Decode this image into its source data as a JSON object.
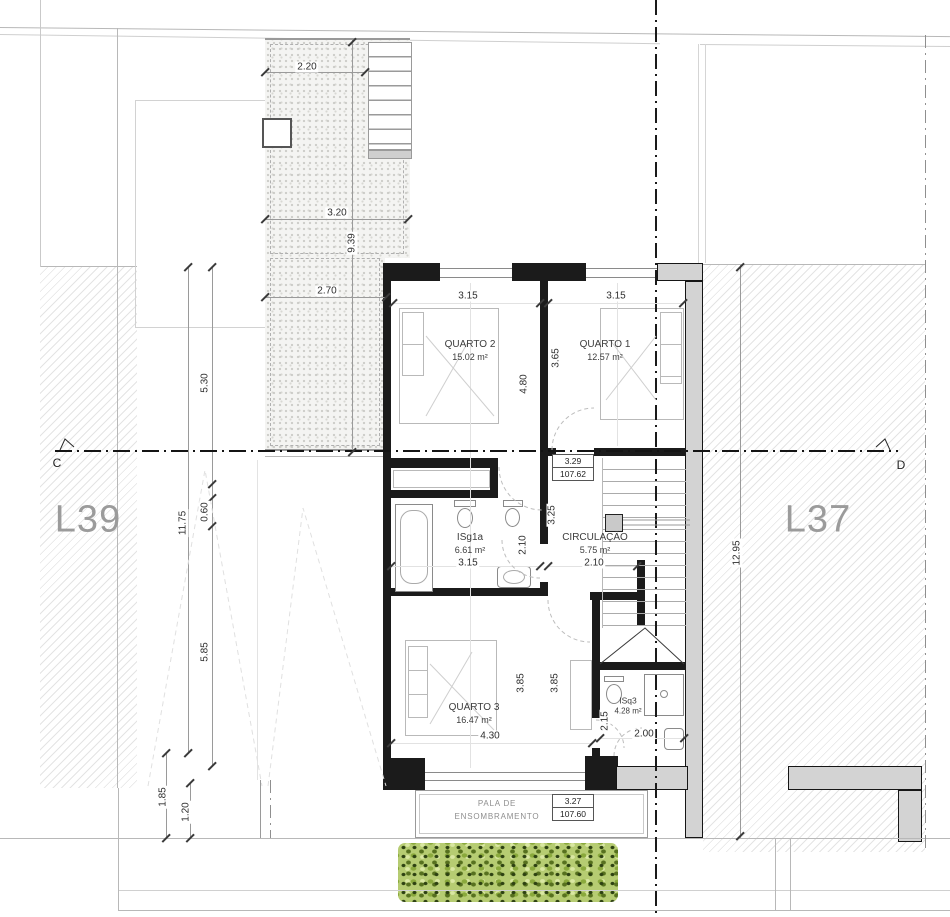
{
  "drawing": {
    "type": "architectural floor plan",
    "floor_level": "upper floor"
  },
  "lots": {
    "left": "L39",
    "right": "L37"
  },
  "section_markers": {
    "left": "C",
    "right": "D"
  },
  "rooms": {
    "quarto2": {
      "name": "QUARTO 2",
      "area": "15.02 m²"
    },
    "quarto1": {
      "name": "QUARTO 1",
      "area": "12.57 m²"
    },
    "isg1a": {
      "name": "ISg1a",
      "area": "6.61 m²"
    },
    "circulacao": {
      "name": "CIRCULAÇÃO",
      "area": "5.75 m²"
    },
    "quarto3": {
      "name": "QUARTO 3",
      "area": "16.47 m²"
    },
    "isq3": {
      "name": "ISq3",
      "area": "4.28 m²"
    }
  },
  "levels": {
    "floor": {
      "value": "3.29",
      "elevation": "107.62"
    },
    "pala": {
      "value": "3.27",
      "elevation": "107.60"
    }
  },
  "pala": {
    "line1": "PALA DE",
    "line2": "ENSOMBRAMENTO"
  },
  "dimensions": {
    "court_top": "2.20",
    "court_mid": "3.20",
    "court_height": "9.39",
    "court_low": "2.70",
    "left_a": "5.30",
    "left_total": "11.75",
    "left_b": "0.60",
    "left_c": "5.85",
    "left_d": "1.85",
    "left_e": "1.20",
    "right_total": "12.95",
    "q2_width": "3.15",
    "q1_width": "3.15",
    "q2_height": "4.80",
    "q1_height": "3.65",
    "hall_height": "3.25",
    "isg_height": "2.10",
    "isg_width": "3.15",
    "circ_width": "2.10",
    "q3_h1": "3.85",
    "q3_h2": "3.85",
    "q3_width": "4.30",
    "isq3_height": "2.15",
    "isq3_width": "2.00"
  },
  "colors": {
    "wall": "#1b1b1b",
    "concrete": "#d3d3d3",
    "hatch_line": "#e4e4e4",
    "lot_label": "#9b9b9b",
    "vegetation": "#8aa93c",
    "dimension_text": "#2e2e2e"
  }
}
